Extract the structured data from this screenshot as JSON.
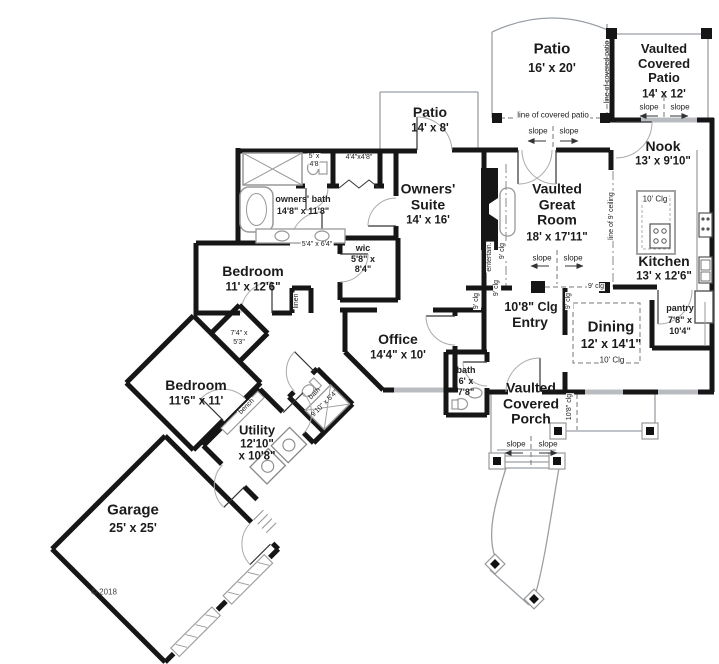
{
  "rooms": {
    "patio_large": {
      "name": "Patio",
      "dims": "16' x 20'"
    },
    "covered_patio": {
      "name": "Vaulted Covered Patio",
      "dims": "14' x 12'"
    },
    "nook": {
      "name": "Nook",
      "dims": "13' x 9'10\""
    },
    "patio_small": {
      "name": "Patio",
      "dims": "14' x 8'"
    },
    "owners_suite": {
      "name": "Owners' Suite",
      "dims": "14' x 16'"
    },
    "great_room": {
      "name": "Vaulted Great Room",
      "dims": "18' x 17'11\""
    },
    "kitchen": {
      "name": "Kitchen",
      "dims": "13' x 12'6\""
    },
    "bedroom1": {
      "name": "Bedroom",
      "dims": "11' x 12'6\""
    },
    "office": {
      "name": "Office",
      "dims": "14'4\" x 10'"
    },
    "entry": {
      "name": "Entry",
      "ceiling": "10'8\" Clg"
    },
    "dining": {
      "name": "Dining",
      "dims": "12' x 14'1\"",
      "ceiling": "10' Clg"
    },
    "bedroom2": {
      "name": "Bedroom",
      "dims": "11'6\" x 11'"
    },
    "utility": {
      "name": "Utility",
      "dims_line1": "12'10\"",
      "dims_line2": "x 10'8\""
    },
    "garage": {
      "name": "Garage",
      "dims": "25' x 25'"
    },
    "porch": {
      "name": "Vaulted Covered Porch"
    },
    "owners_bath": {
      "name": "owners' bath",
      "dims": "14'8\" x 11'8\""
    },
    "wic": {
      "name": "wic",
      "dims_line1": "5'8\" x",
      "dims_line2": "8'4\""
    },
    "pantry": {
      "name": "pantry",
      "dims_line1": "7'8\" x",
      "dims_line2": "10'4\""
    },
    "bath_hall": {
      "name": "bath",
      "dims_line1": "6' x",
      "dims_line2": "7'8\""
    },
    "bath_wing": {
      "name": "bath",
      "dims": "9'10\" x 5'4\""
    },
    "toilet_room": {
      "dims_line1": "5' x",
      "dims_line2": "4'8"
    },
    "closet_suite": {
      "dims": "4'4\"x4'8\""
    },
    "hall_dims": {
      "dims": "5'4\" x 6'4\""
    },
    "closet_bed2": {
      "dims_line1": "7'4\" x",
      "dims_line2": "5'3\""
    }
  },
  "annotations": {
    "slope": "slope",
    "line_of_covered_patio": "line of covered patio",
    "line_of_9_ceiling": "line of 9' ceiling",
    "clg_9": "9' clg",
    "clg_10": "10' Clg",
    "clg_10_8": "10'8\" clg",
    "entertain": "entertain.",
    "bench": "bench",
    "linen": "linen",
    "copyright": "© 2018"
  }
}
